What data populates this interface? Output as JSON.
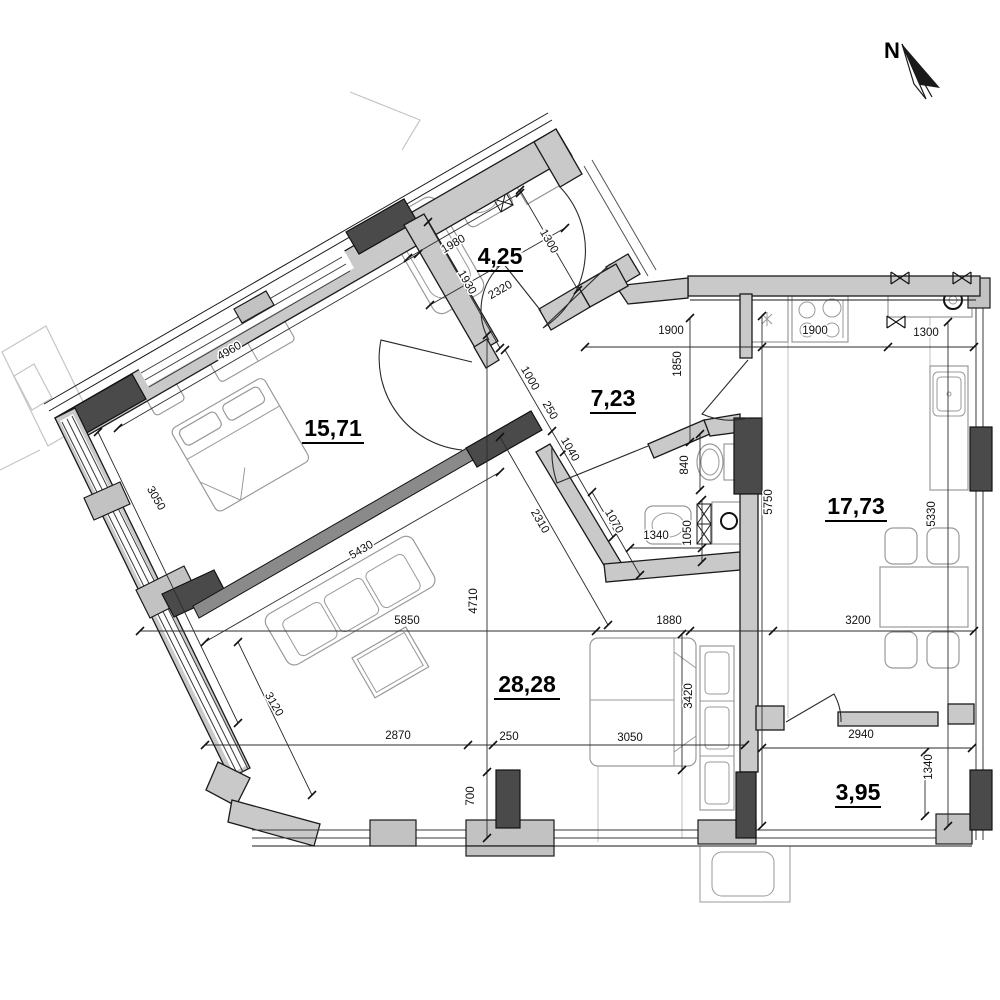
{
  "north_arrow": {
    "label": "N"
  },
  "colors": {
    "background": "#ffffff",
    "wall_fill": "#c9c9c9",
    "wall_dark": "#4a4a4a",
    "line": "#1a1a1a",
    "furniture_stroke": "#9a9a9a"
  },
  "rooms": [
    {
      "name": "bedroom",
      "area_label": "15,71"
    },
    {
      "name": "bathroom",
      "area_label": "4,25"
    },
    {
      "name": "hallway",
      "area_label": "7,23"
    },
    {
      "name": "kitchen",
      "area_label": "17,73"
    },
    {
      "name": "living-room",
      "area_label": "28,28"
    },
    {
      "name": "balcony",
      "area_label": "3,95"
    }
  ],
  "dimensions": [
    {
      "label": "1980"
    },
    {
      "label": "1300"
    },
    {
      "label": "2320"
    },
    {
      "label": "1930"
    },
    {
      "label": "4960"
    },
    {
      "label": "3050"
    },
    {
      "label": "5430"
    },
    {
      "label": "1000"
    },
    {
      "label": "250"
    },
    {
      "label": "1040"
    },
    {
      "label": "2310"
    },
    {
      "label": "1070"
    },
    {
      "label": "840"
    },
    {
      "label": "1340"
    },
    {
      "label": "1050"
    },
    {
      "label": "1900"
    },
    {
      "label": "1850"
    },
    {
      "label": "1900"
    },
    {
      "label": "1300"
    },
    {
      "label": "5750"
    },
    {
      "label": "5330"
    },
    {
      "label": "3200"
    },
    {
      "label": "1880"
    },
    {
      "label": "5850"
    },
    {
      "label": "4710"
    },
    {
      "label": "3120"
    },
    {
      "label": "2870"
    },
    {
      "label": "250"
    },
    {
      "label": "3050"
    },
    {
      "label": "3420"
    },
    {
      "label": "700"
    },
    {
      "label": "2940"
    },
    {
      "label": "1340"
    }
  ]
}
